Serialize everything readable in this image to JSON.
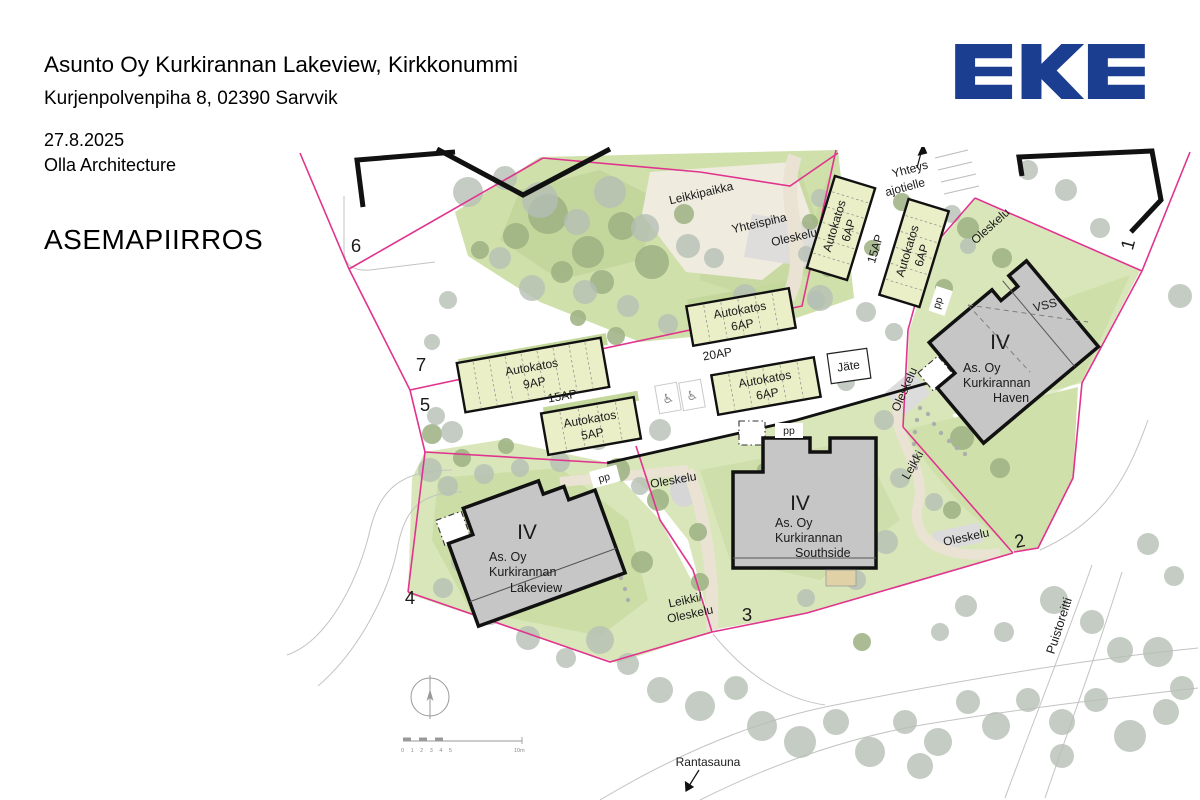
{
  "header": {
    "title": "Asunto Oy Kurkirannan Lakeview, Kirkkonummi",
    "address": "Kurjenpolvenpiha 8, 02390 Sarvvik",
    "date": "27.8.2025",
    "firm": "Olla Architecture",
    "drawing_label": "ASEMAPIIRROS"
  },
  "logo": {
    "text": "EKE",
    "color": "#1B3E90"
  },
  "colors": {
    "boundary_magenta": "#E0348E",
    "building_fill": "#C6C6C6",
    "building_stroke": "#111111",
    "carport_fill": "#EAEFC8",
    "park_green": "#CFE0AB",
    "plot_green": "#D9E6BA",
    "bright_green": "#C3D89A",
    "tree_gray": "#B5BFB5",
    "tree_green": "#9CB082",
    "sand": "#EFEBDE",
    "logo_navy": "#1B3E90"
  },
  "plan": {
    "buildings": [
      {
        "id": "lakeview",
        "floors": "IV",
        "line1": "As. Oy",
        "line2": "Kurkirannan",
        "line3": "Lakeview"
      },
      {
        "id": "southside",
        "floors": "IV",
        "line1": "As. Oy",
        "line2": "Kurkirannan",
        "line3": "Southside"
      },
      {
        "id": "haven",
        "floors": "IV",
        "line1": "As. Oy",
        "line2": "Kurkirannan",
        "line3": "Haven"
      }
    ],
    "carports": [
      {
        "label": "Autokatos",
        "capacity": "9AP"
      },
      {
        "label": "Autokatos",
        "capacity": "5AP"
      },
      {
        "label": "Autokatos",
        "capacity": "6AP"
      },
      {
        "label": "Autokatos",
        "capacity": "6AP"
      },
      {
        "label": "Autokatos",
        "capacity": "6AP"
      },
      {
        "label": "Autokatos",
        "capacity": "6AP"
      }
    ],
    "parking": {
      "p15_west": "15AP",
      "p20": "20AP",
      "p15_east": "15AP"
    },
    "plots": {
      "p1": "1",
      "p2": "2",
      "p3": "3",
      "p4": "4",
      "p5": "5",
      "p6": "6",
      "p7": "7"
    },
    "labels": {
      "leikkipaikka": "Leikkipaikka",
      "yhteispiha": "Yhteispiha",
      "oleskelu": "Oleskelu",
      "leikki": "Leikki",
      "leikki_oleskelu_1": "Leikki/",
      "leikki_oleskelu_2": "Oleskelu",
      "yhteys_1": "Yhteys",
      "yhteys_2": "ajotielle",
      "jate": "Jäte",
      "pp": "pp",
      "vss": "VSS",
      "rantasauna": "Rantasauna",
      "puistoreitti": "Puistoreitti"
    },
    "scale_bar": {
      "ticks": "0 1 2 3 4 5",
      "end": "10m"
    }
  }
}
